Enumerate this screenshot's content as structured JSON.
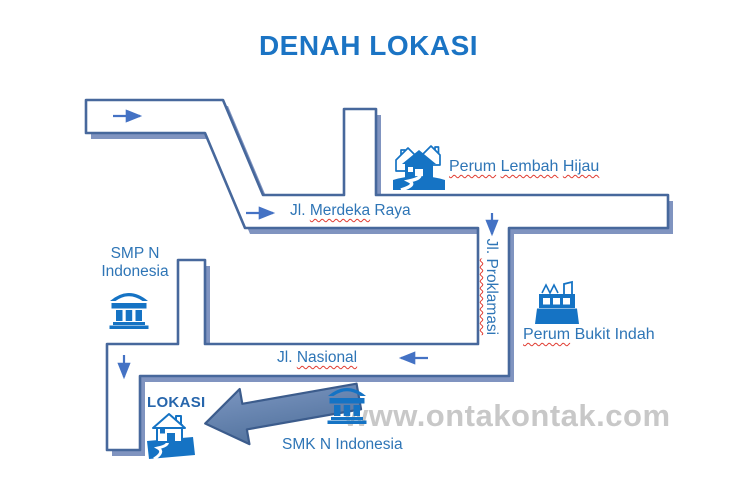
{
  "title": "DENAH LOKASI",
  "watermark": "www.ontakontak.com",
  "roads": {
    "merdeka": {
      "jl": "Jl. ",
      "name": "Merdeka",
      "rest": " Raya"
    },
    "proklamasi": {
      "jl": "Jl. ",
      "name": "Proklamasi"
    },
    "nasional": {
      "jl": "Jl. ",
      "name": "Nasional"
    }
  },
  "landmarks": {
    "lembah_hijau": {
      "word1": "Perum",
      "sp1": " ",
      "word2": "Lembah",
      "sp2": " ",
      "word3": "Hijau",
      "icon": "houses-icon"
    },
    "bukit_indah": {
      "word1": "Perum",
      "rest": " Bukit Indah",
      "icon": "factory-icon"
    },
    "smp": {
      "line1": "SMP N",
      "line2": "Indonesia",
      "icon": "bank-icon"
    },
    "smk": {
      "label": "SMK N Indonesia",
      "icon": "bank-icon"
    },
    "lokasi": {
      "label": "LOKASI",
      "icon": "home-icon",
      "pointer": "big-left-arrow"
    }
  },
  "colors": {
    "title_blue": "#1B74C4",
    "label_blue": "#2E75B6",
    "road_border": "#47689C",
    "road_shadow": "#8094C0",
    "arrow_blue": "#4472C4",
    "spellcheck_red": "#E03B30",
    "watermark_gray": "#C8C8C8",
    "big_arrow_fill": "#5E81B4",
    "icon_blue": "#1573C4"
  }
}
